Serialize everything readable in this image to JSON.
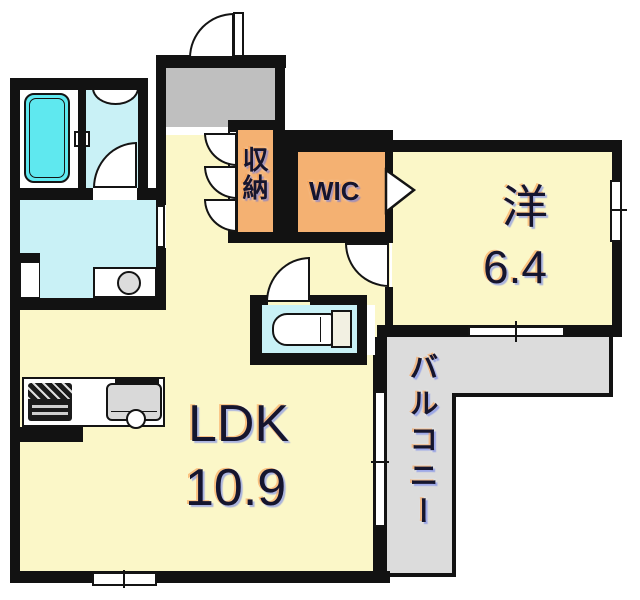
{
  "title": "apartment-floor-plan",
  "rooms": {
    "ldk": {
      "label": "LDK",
      "area": "10.9"
    },
    "western": {
      "label": "洋",
      "area": "6.4"
    },
    "wic": {
      "label": "WIC"
    },
    "storage": {
      "label": "収納"
    },
    "balcony": {
      "label": "バルコニー"
    }
  },
  "fixtures": [
    "bathtub-icon",
    "washbasin-icon",
    "vanity-basin-icon",
    "toilet-icon",
    "stove-icon",
    "kitchen-sink-icon",
    "entry-door-arc",
    "wic-folding-door-icon"
  ],
  "colors": {
    "room_yellow": "#FBF7C8",
    "sanitary_cyan": "#C9F1F6",
    "bathtub_cyan": "#5FE8EF",
    "closet_orange": "#F4B172",
    "entrance_gray": "#BFBFBF",
    "balcony_gray": "#DCDCDC",
    "wall_black": "#121212"
  }
}
